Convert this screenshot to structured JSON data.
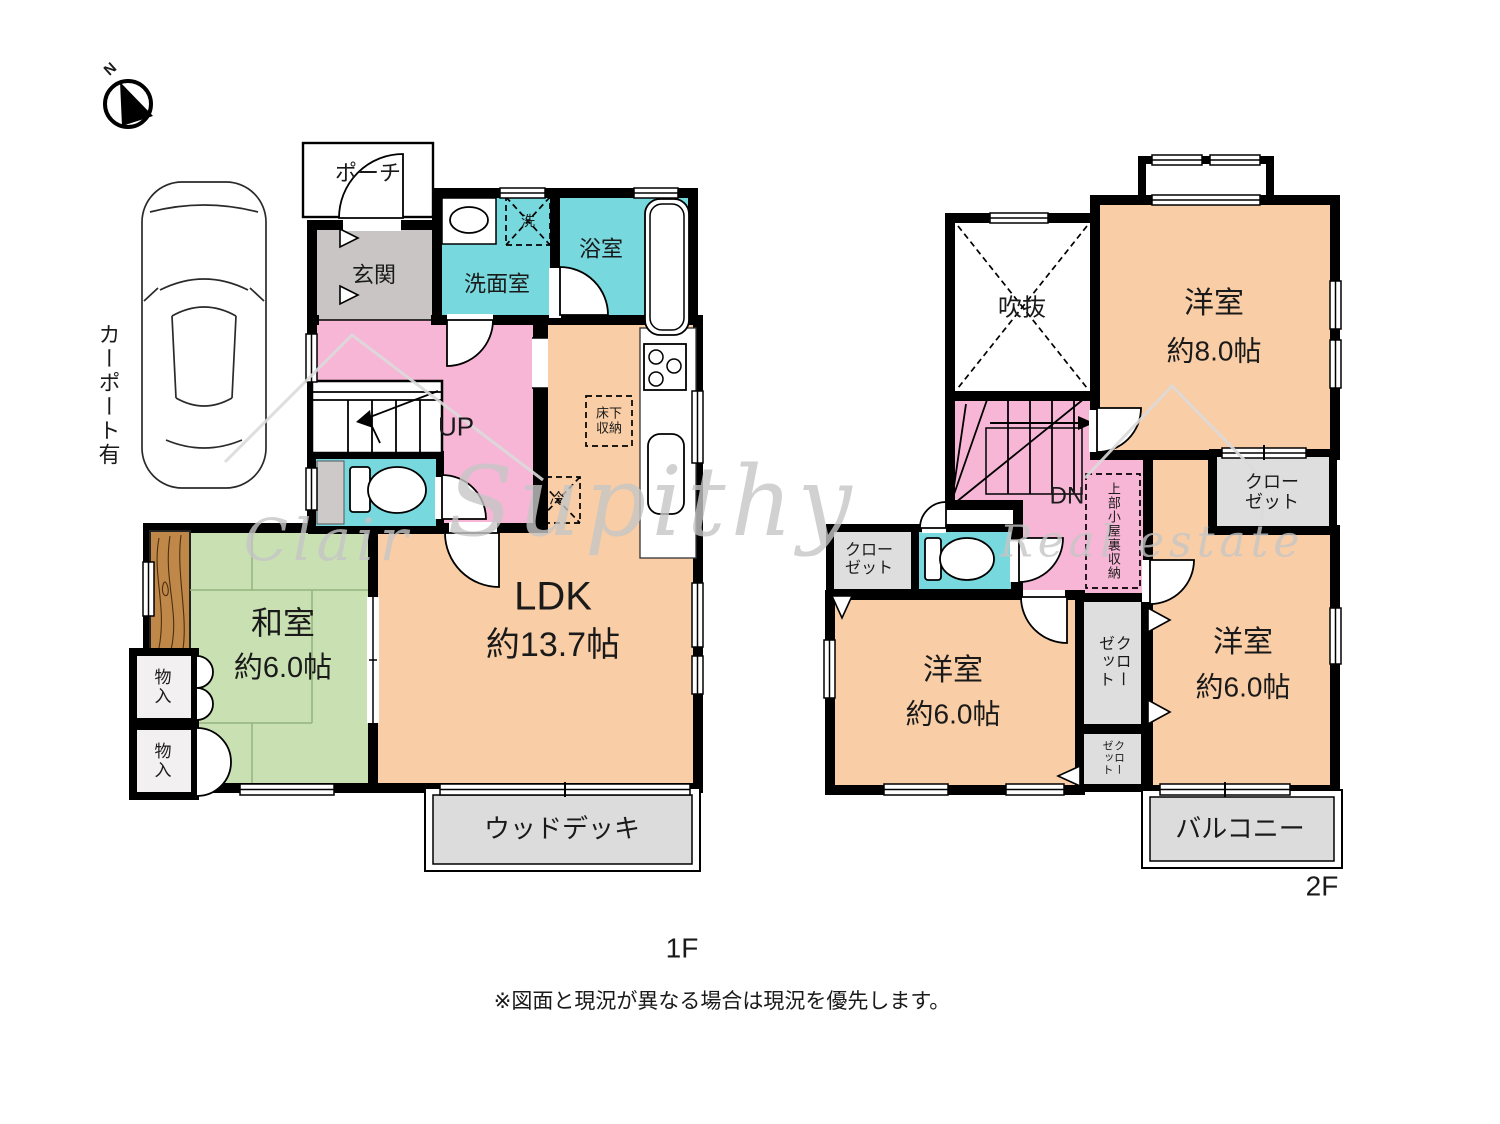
{
  "colors": {
    "wall": "#000000",
    "pink": "#f7b6d6",
    "teal": "#77d8dd",
    "orange": "#f9cda6",
    "green": "#c8e0b2",
    "gray_entrance": "#c9c5c5",
    "gray_light": "#dcdcdc",
    "closet_gray": "#dedede",
    "wood": "#c08848"
  },
  "compass": {
    "north": "N"
  },
  "carport_label": "カーポート有",
  "watermark": {
    "word1": "Clair",
    "word2": "Supithy",
    "word3": "Real estate"
  },
  "note": "※図面と現況が異なる場合は現況を優先します。",
  "floor1": {
    "label": "1F",
    "porch": "ポーチ",
    "entrance": "玄関",
    "washroom": "洗面室",
    "bathroom": "浴室",
    "washer": "洗",
    "stairs": "UP",
    "underfloor_storage": "床下\n収納",
    "fridge": "冷",
    "ldk_name": "LDK",
    "ldk_size": "約13.7帖",
    "japanese_room_name": "和室",
    "japanese_room_size": "約6.0帖",
    "storage_1": "物\n入",
    "storage_2": "物\n入",
    "wood_deck": "ウッドデッキ"
  },
  "floor2": {
    "label": "2F",
    "void": "吹抜",
    "stairs": "DN",
    "attic_storage": "上部小屋裏収納",
    "west_room_8_name": "洋室",
    "west_room_8_size": "約8.0帖",
    "closet_top_right": "クロー\nゼット",
    "closet_left": "クロー\nゼット",
    "closet_mid_upper": "クローゼット",
    "closet_mid_lower": "クローゼット",
    "west_room_6l_name": "洋室",
    "west_room_6l_size": "約6.0帖",
    "west_room_6r_name": "洋室",
    "west_room_6r_size": "約6.0帖",
    "balcony": "バルコニー"
  }
}
